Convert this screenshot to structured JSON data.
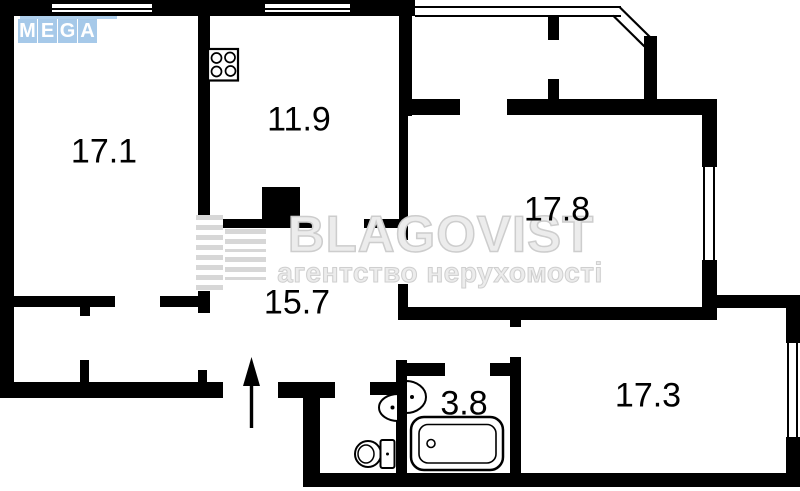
{
  "plan": {
    "rooms": {
      "r17_1": {
        "label": "17.1"
      },
      "r11_9": {
        "label": "11.9"
      },
      "r17_8": {
        "label": "17.8"
      },
      "r15_7": {
        "label": "15.7"
      },
      "r3_8": {
        "label": "3.8"
      },
      "r17_3": {
        "label": "17.3"
      }
    }
  },
  "watermark": {
    "brand": "BLAGOVIST",
    "tagline": "агентство нерухомості",
    "text_color": "#ececec",
    "outline_color": "#cdcdcd"
  },
  "mega_logo": {
    "letters": [
      "M",
      "E",
      "G",
      "A"
    ],
    "tile_color": "#a6c9e9",
    "letter_color": "#ffffff",
    "line_color": "#aecfed"
  },
  "colors": {
    "wall": "#000000",
    "background": "#ffffff"
  },
  "icons": {
    "stove": "stove-icon",
    "bathtub": "bathtub-icon",
    "toilet": "toilet-icon",
    "wc_sink": "sink-icon",
    "bath_sink": "sink-icon",
    "entrance_arrow": "entrance-arrow-icon",
    "vent_shaft": "vent-shaft-block"
  }
}
